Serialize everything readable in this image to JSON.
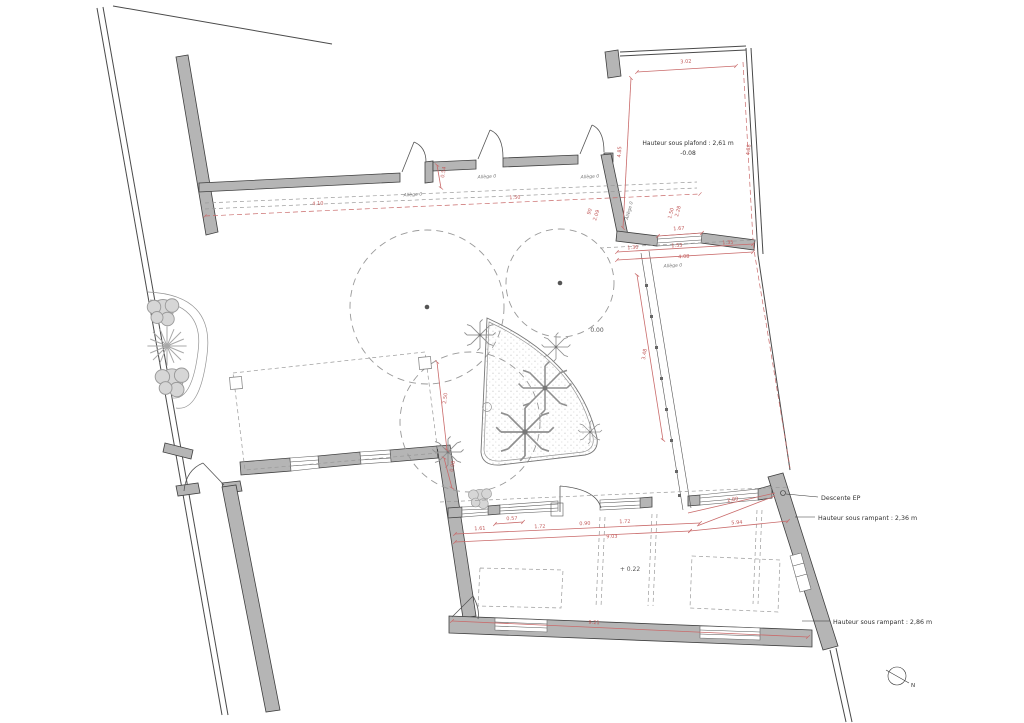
{
  "texts": {
    "ceiling_height": "Hauteur sous plafond : 2,61 m",
    "level_room": "-0.08",
    "level_courtyard": "0.00",
    "level_bottom_room": "+ 0.22",
    "descente_ep": "Descente EP",
    "rampant_upper": "Hauteur sous rampant : 2,36 m",
    "rampant_lower": "Hauteur sous rampant : 2,86 m",
    "allege": "Allège 0",
    "north": "N"
  },
  "dims": {
    "room_width": "3.02",
    "room_height_left": "4.85",
    "room_height_right": "4.88",
    "opening_167": "1.67",
    "seg_130": "1.30",
    "seg_153": "1.53",
    "seg_135": "1.35",
    "total_408": "4.08",
    "stack_150": "1.50",
    "stack_228": "2.28",
    "door_90": "90",
    "door_209": "2.09",
    "court_410": "4.10",
    "court_150": "1.50",
    "step_054": "0.54",
    "ramp_348": "3.48",
    "canopy_250": "2.50",
    "canopy_098": "0.98",
    "b_161": "1.61",
    "b_057": "0.57",
    "b_172a": "1.72",
    "b_090": "0.90",
    "b_172b": "1.72",
    "b_903": "9.03",
    "b_594": "5.94",
    "b_280": "2.80",
    "b_921": "9.21"
  },
  "colors": {
    "dimension": "#c96a6a",
    "wall_fill": "#b5b5b5",
    "line": "#444444"
  }
}
